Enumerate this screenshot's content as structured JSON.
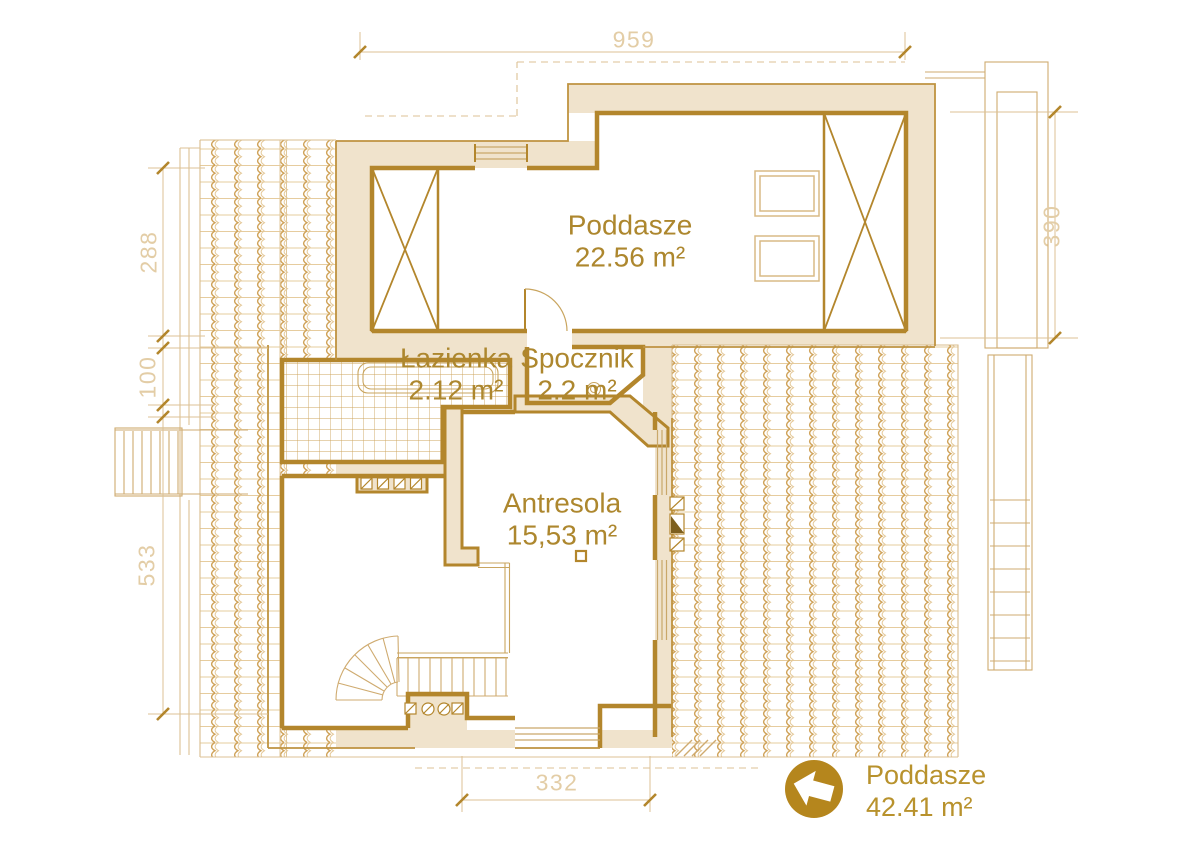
{
  "plan": {
    "title_hint": "attic floor plan",
    "rooms": {
      "poddasze": {
        "name": "Poddasze",
        "area": "22.56 m²"
      },
      "lazienka": {
        "name": "Łazienka",
        "area": "2.12 m²"
      },
      "spocznik": {
        "name": "Spocznik",
        "area": "2.2 m²"
      },
      "antresola": {
        "name": "Antresola",
        "area": "15,53 m²"
      }
    },
    "dimensions": {
      "top": "959",
      "left_upper": "288",
      "left_mid": "100",
      "left_lower": "533",
      "right": "390",
      "bottom": "332"
    },
    "legend": {
      "floor_name": "Poddasze",
      "floor_area": "42.41 m²"
    },
    "icons": {
      "floor_nav_arrow": "left-arrow-in-circle"
    },
    "colors": {
      "wall_line": "#b3862c",
      "wall_fill": "#f0e3cc",
      "roof_tile": "#cfa258",
      "thin_line": "#cfab70",
      "label_text": "#ad872e",
      "dimension_text": "#e3cda6",
      "badge": "#b5861d"
    }
  }
}
